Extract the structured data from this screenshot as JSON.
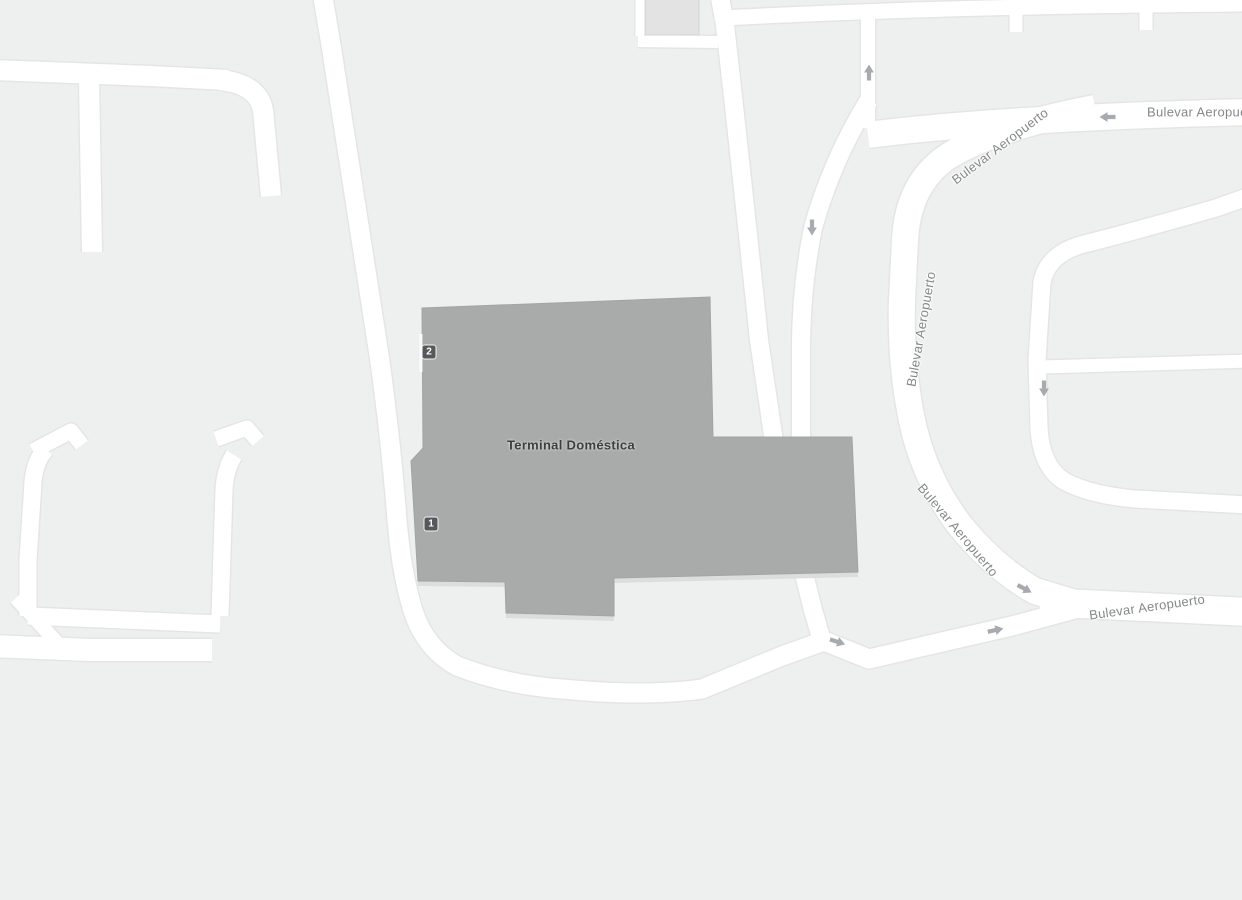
{
  "map": {
    "colors": {
      "background": "#eef0ef",
      "road_fill": "#ffffff",
      "road_casing": "#e4e6e5",
      "building_fill": "#a9abaa",
      "building_outline": "#a3a5a4",
      "building_shadow": "#dcdedd",
      "small_building_fill": "#e2e3e2",
      "small_building_outline": "#d2d4d3",
      "marker_bg": "#57585b",
      "marker_text": "#ffffff",
      "road_label": "#85878a",
      "building_label": "#3d3e40",
      "arrow": "#a7aaae"
    },
    "building": {
      "label": "Terminal Doméstica"
    },
    "markers": [
      {
        "label": "2"
      },
      {
        "label": "1"
      }
    ],
    "road_labels": {
      "top_right": "Bulevar Aeropuerto",
      "diagonal_top": "Bulevar Aeropuerto",
      "vertical_mid": "Bulevar Aeropuerto",
      "diagonal_bottom": "Bulevar Aeropuerto",
      "bottom_right": "Bulevar Aeropuerto"
    },
    "icons": {
      "one_way_arrow": "one-way-arrow-icon",
      "entrance_marker": "entrance-number-marker"
    }
  }
}
